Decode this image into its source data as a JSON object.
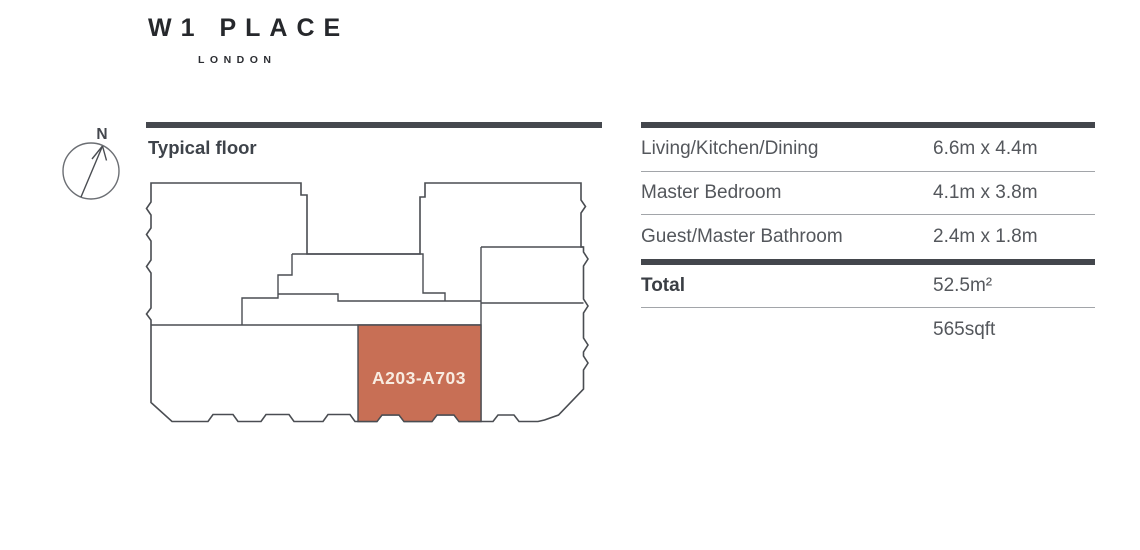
{
  "brand": {
    "name": "W1 PLACE",
    "city": "LONDON"
  },
  "compass": {
    "label": "N"
  },
  "plan": {
    "title": "Typical floor",
    "unit_label": "A203-A703",
    "unit_fill_color": "#c86f55",
    "unit_label_color": "#f8ece1",
    "line_color": "#4a4d52"
  },
  "table": {
    "rows": [
      {
        "label": "Living/Kitchen/Dining",
        "value": "6.6m x 4.4m"
      },
      {
        "label": "Master Bedroom",
        "value": "4.1m x 3.8m"
      },
      {
        "label": "Guest/Master Bathroom",
        "value": "2.4m x 1.8m"
      },
      {
        "label": "Total",
        "value": "52.5m²"
      },
      {
        "label": "",
        "value": "565sqft"
      }
    ]
  }
}
